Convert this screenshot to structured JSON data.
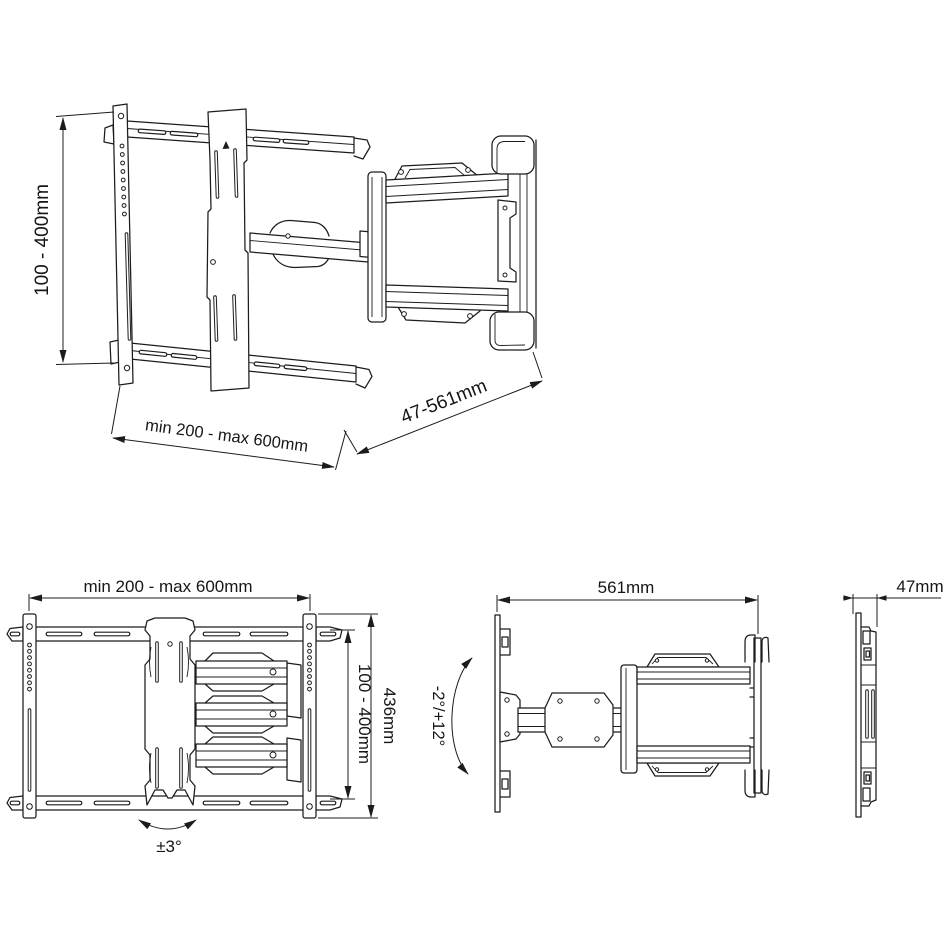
{
  "page": {
    "background": "#ffffff",
    "line_color": "#1c1c1c",
    "description": "Dimensional line drawing of an articulating TV wall mount, four views"
  },
  "views": {
    "perspective": {
      "title": "perspective-view",
      "dims": {
        "height_range": "100 - 400mm",
        "width_range": "min 200 - max 600mm",
        "extension_range": "47-561mm"
      }
    },
    "front": {
      "title": "front-view",
      "dims": {
        "width_range": "min 200 - max 600mm",
        "inner_height_range": "100 - 400mm",
        "total_height": "436mm",
        "tilt_range": "±3°"
      }
    },
    "plan": {
      "title": "top-view",
      "dims": {
        "max_extension": "561mm",
        "swivel_range": "-2°/+12°"
      }
    },
    "side": {
      "title": "side-view-folded",
      "dims": {
        "depth_folded": "47mm"
      }
    }
  }
}
